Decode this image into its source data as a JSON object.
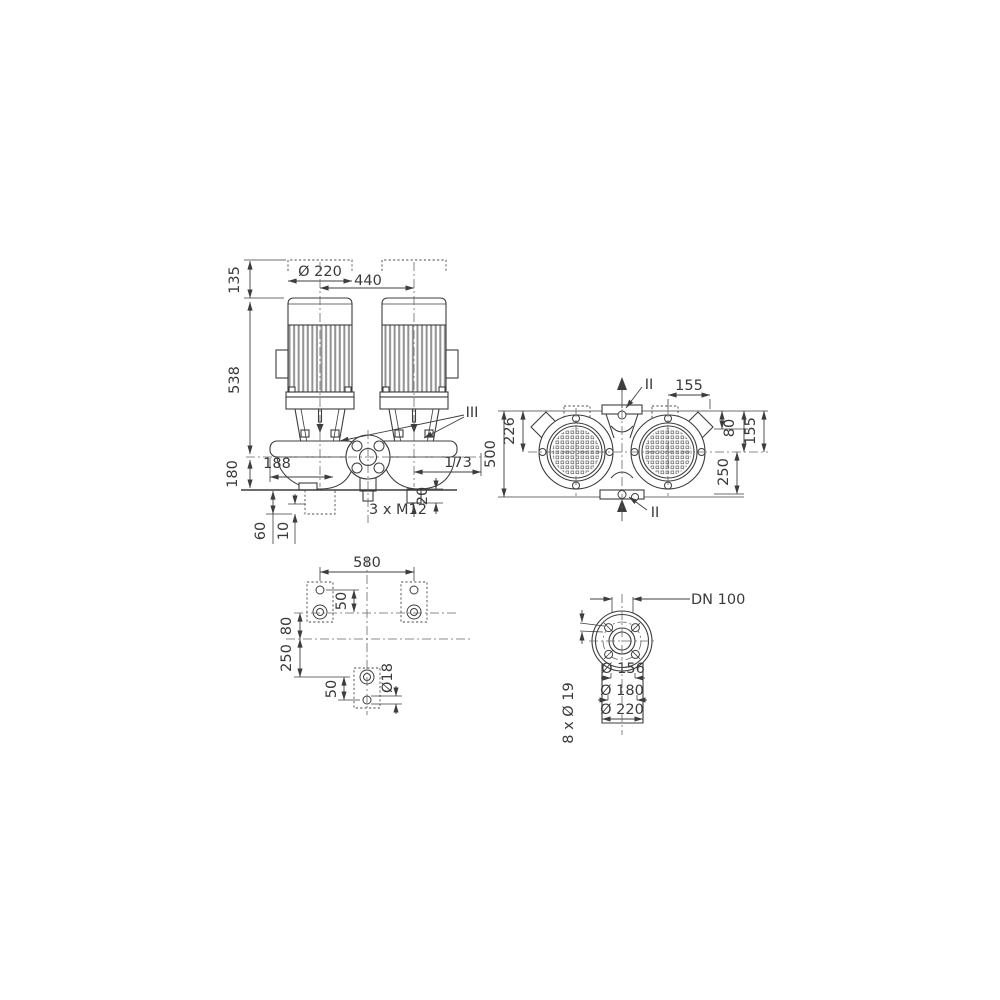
{
  "drawing_type": "pump dimensional drawing, twin in-line pump, three orthographic views plus flange detail",
  "colors": {
    "line": "#3d3d3d",
    "centerline": "#666666",
    "fin_shade": "#929292",
    "background": "#ffffff"
  },
  "front_view": {
    "labels": {
      "envelope_height": "135",
      "pump_height": "538",
      "axis_height": "180",
      "motor_diameter": "Ø 220",
      "pump_spacing": "440",
      "foot_left": "188",
      "foot_right": "173",
      "drain_plug_length": "20",
      "drain_thread": "3 x M12",
      "base_height": "60",
      "base_step": "10",
      "detail_ref": "III"
    }
  },
  "top_view": {
    "labels": {
      "overall_length": "500",
      "edge_to_axis": "226",
      "port_to_end": "155",
      "box_offset": "80",
      "edge_offset": "155",
      "axis_to_end": "250",
      "section_top": "II",
      "section_bottom": "II"
    }
  },
  "foundation_view": {
    "labels": {
      "bolt_span": "580",
      "hole_pitch_upper": "50",
      "axis_offset": "80",
      "axis_to_anchor": "250",
      "hole_pitch_lower": "50",
      "anchor_hole": "Ø18"
    }
  },
  "flange_view": {
    "labels": {
      "nominal_bore": "DN 100",
      "pilot_diameter": "Ø 156",
      "bolt_circle": "Ø 180",
      "outer_diameter": "Ø 220",
      "bolt_holes": "8 x Ø 19"
    }
  }
}
